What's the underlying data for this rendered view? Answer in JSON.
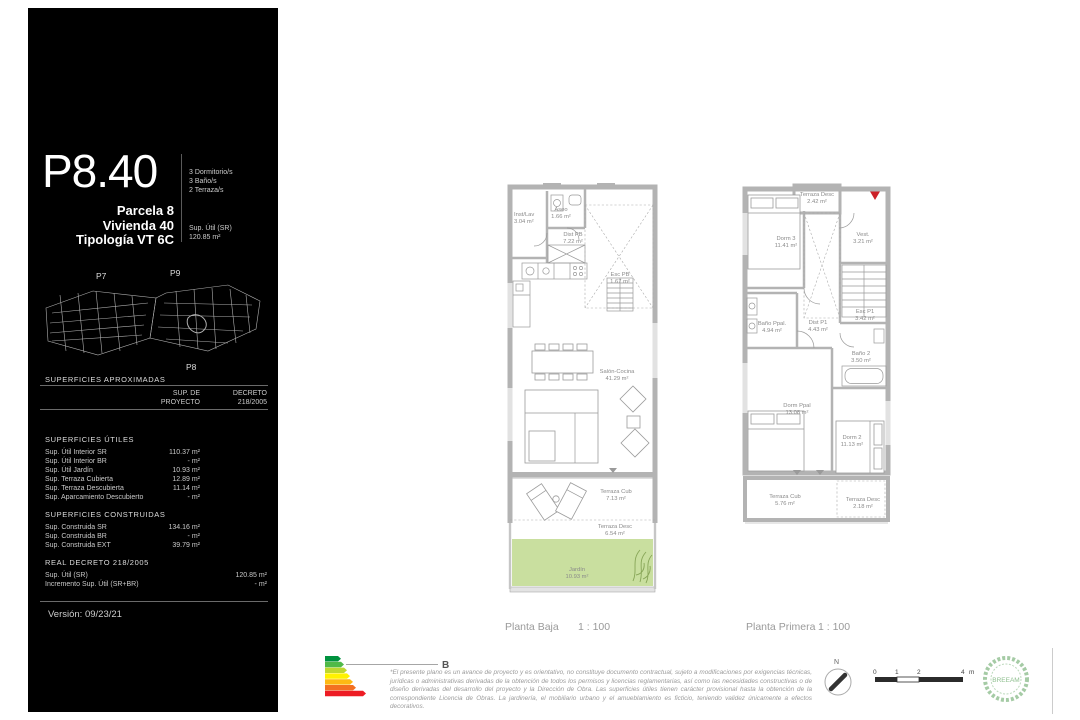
{
  "sidebar": {
    "unit_code": "P8.40",
    "unit_lines": [
      "Parcela 8",
      "Vivienda 40",
      "Tipología VT 6C"
    ],
    "features": [
      "3 Dormitorio/s",
      "3 Baño/s",
      "2 Terraza/s"
    ],
    "sup_util_label": "Sup. Útil (SR)",
    "sup_util_value": "120.85 m²",
    "siteplan": {
      "p7": "P7",
      "p9": "P9",
      "p8": "P8"
    },
    "approx_title": "SUPERFICIES APROXIMADAS",
    "table_header": {
      "col1_line1": "SUP. DE",
      "col1_line2": "PROYECTO",
      "col2_line1": "DECRETO",
      "col2_line2": "218/2005"
    },
    "utiles": {
      "title": "SUPERFICIES ÚTILES",
      "rows": [
        {
          "label": "Sup. Útil Interior SR",
          "value": "110.37 m²"
        },
        {
          "label": "Sup. Útil Interior BR",
          "value": "- m²"
        },
        {
          "label": "Sup. Útil Jardín",
          "value": "10.93 m²"
        },
        {
          "label": "Sup. Terraza Cubierta",
          "value": "12.89 m²"
        },
        {
          "label": "Sup. Terraza Descubierta",
          "value": "11.14 m²"
        },
        {
          "label": "Sup. Aparcamiento Descubierto",
          "value": "- m²"
        }
      ]
    },
    "construidas": {
      "title": "SUPERFICIES CONSTRUIDAS",
      "rows": [
        {
          "label": "Sup. Construida SR",
          "value": "134.16 m²"
        },
        {
          "label": "Sup. Construida BR",
          "value": "- m²"
        },
        {
          "label": "Sup. Construida EXT",
          "value": "39.79 m²"
        }
      ]
    },
    "decreto": {
      "title": "REAL DECRETO 218/2005",
      "rows": [
        {
          "label": "Sup. Útil (SR)",
          "value": "120.85 m²"
        },
        {
          "label": "Incremento Sup. Útil (SR+BR)",
          "value": "- m²"
        }
      ]
    },
    "version": "Versión: 09/23/21"
  },
  "plans": {
    "baja": {
      "caption": "Planta Baja",
      "scale": "1 : 100",
      "rooms": {
        "inst_lav": {
          "name": "Inst/Lav",
          "area": "3.04 m²"
        },
        "aseo": {
          "name": "Aseo",
          "area": "1.66 m²"
        },
        "dist": {
          "name": "Dist PB",
          "area": "7.22 m²"
        },
        "esc": {
          "name": "Esc PB",
          "area": "1.67 m²"
        },
        "salon": {
          "name": "Salón-Cocina",
          "area": "41.29 m²"
        },
        "terraza_cub": {
          "name": "Terraza Cub",
          "area": "7.13 m²"
        },
        "terraza_desc": {
          "name": "Terraza Desc",
          "area": "6.54 m²"
        },
        "jardin": {
          "name": "Jardín",
          "area": "10.93 m²"
        }
      }
    },
    "primera": {
      "caption": "Planta Primera",
      "scale": "1 : 100",
      "rooms": {
        "terraza_desc_sup": {
          "name": "Terraza Desc",
          "area": "2.42 m²"
        },
        "dorm3": {
          "name": "Dorm 3",
          "area": "11.41 m²"
        },
        "vest": {
          "name": "Vest.",
          "area": "3.21 m²"
        },
        "dist": {
          "name": "Dist P1",
          "area": "4.43 m²"
        },
        "esc": {
          "name": "Esc P1",
          "area": "3.42 m²"
        },
        "bano_ppal": {
          "name": "Baño Ppal.",
          "area": "4.94 m²"
        },
        "bano2": {
          "name": "Baño 2",
          "area": "3.50 m²"
        },
        "dorm_ppal": {
          "name": "Dorm Ppal",
          "area": "13.08 m²"
        },
        "dorm2": {
          "name": "Dorm 2",
          "area": "11.13 m²"
        },
        "terraza_cub": {
          "name": "Terraza Cub",
          "area": "5.76 m²"
        },
        "terraza_desc_inf": {
          "name": "Terraza Desc",
          "area": "2.18 m²"
        }
      }
    }
  },
  "footer": {
    "energy": {
      "rating": "B",
      "colors": [
        "#00923f",
        "#50b948",
        "#bfd730",
        "#fff200",
        "#fdb913",
        "#f37021",
        "#ed1c24"
      ]
    },
    "disclaimer": "*El presente plano es un avance de proyecto y es orientativo, no constituye documento contractual, sujeto a modificaciones por exigencias técnicas, jurídicas o administrativas derivadas de la obtención de todos los permisos y licencias reglamentarias, así como las necesidades constructivas o de diseño derivadas del desarrollo del proyecto y la Dirección de Obra. Las superficies útiles tienen carácter provisional hasta la obtención de la correspondiente Licencia de Obras. La jardinería, el mobiliario urbano y el amueblamiento es ficticio, teniendo validez únicamente a efectos decorativos.",
    "north_label": "N",
    "scale_bar": {
      "marks": [
        "0",
        "1",
        "2",
        "4"
      ],
      "unit": "m"
    },
    "breeam_label": "BREEAM"
  },
  "colors": {
    "accent_red": "#cc2128",
    "garden_green": "#c9df9f",
    "wall_gray": "#b3b3b3"
  }
}
